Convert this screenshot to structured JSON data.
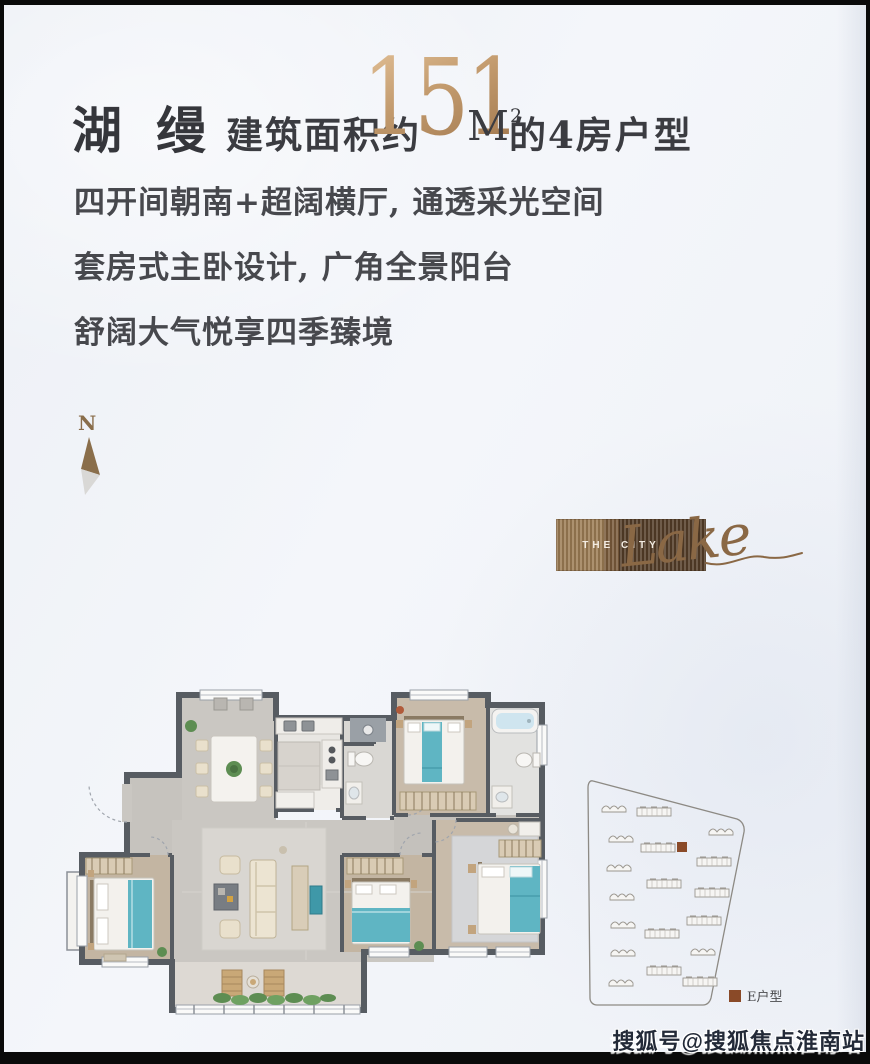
{
  "header": {
    "brand": "湖缦",
    "area_prefix": "建筑面积约",
    "area_value": "151",
    "unit_base": "M",
    "unit_sup": "2",
    "suffix": "的4房户型",
    "gold_light": "#dcb98f",
    "gold_dark": "#a57c52",
    "ink": "#3b3c41"
  },
  "selling_points": {
    "lines": [
      "四开间朝南+超阔横厅, 通透采光空间",
      "套房式主卧设计, 广角全景阳台",
      "舒阔大气悦享四季臻境"
    ]
  },
  "compass": {
    "label": "N",
    "needle_brown": "#8a6e4b",
    "needle_gray": "#d9d8d6"
  },
  "logo": {
    "top_text": "THE CITY",
    "script_text": "Lake",
    "block_light": "#9c7c54",
    "block_dark": "#543d28",
    "script_color": "#8a6845"
  },
  "floorplan": {
    "wall_color": "#575c62",
    "floor_gray": "#cac7c2",
    "floor_wood": "#c8bbaa",
    "floor_tile": "#e8e6e2",
    "bed_teal": "#5fb5c3",
    "tub_blue": "#cfe5ef",
    "plant_green": "#5d8d52"
  },
  "siteplan": {
    "legend_label": "E户型",
    "marker_color": "#8a4a28",
    "outline_color": "#8d8a84"
  },
  "watermark": {
    "text": "搜狐号@搜狐焦点淮南站"
  }
}
